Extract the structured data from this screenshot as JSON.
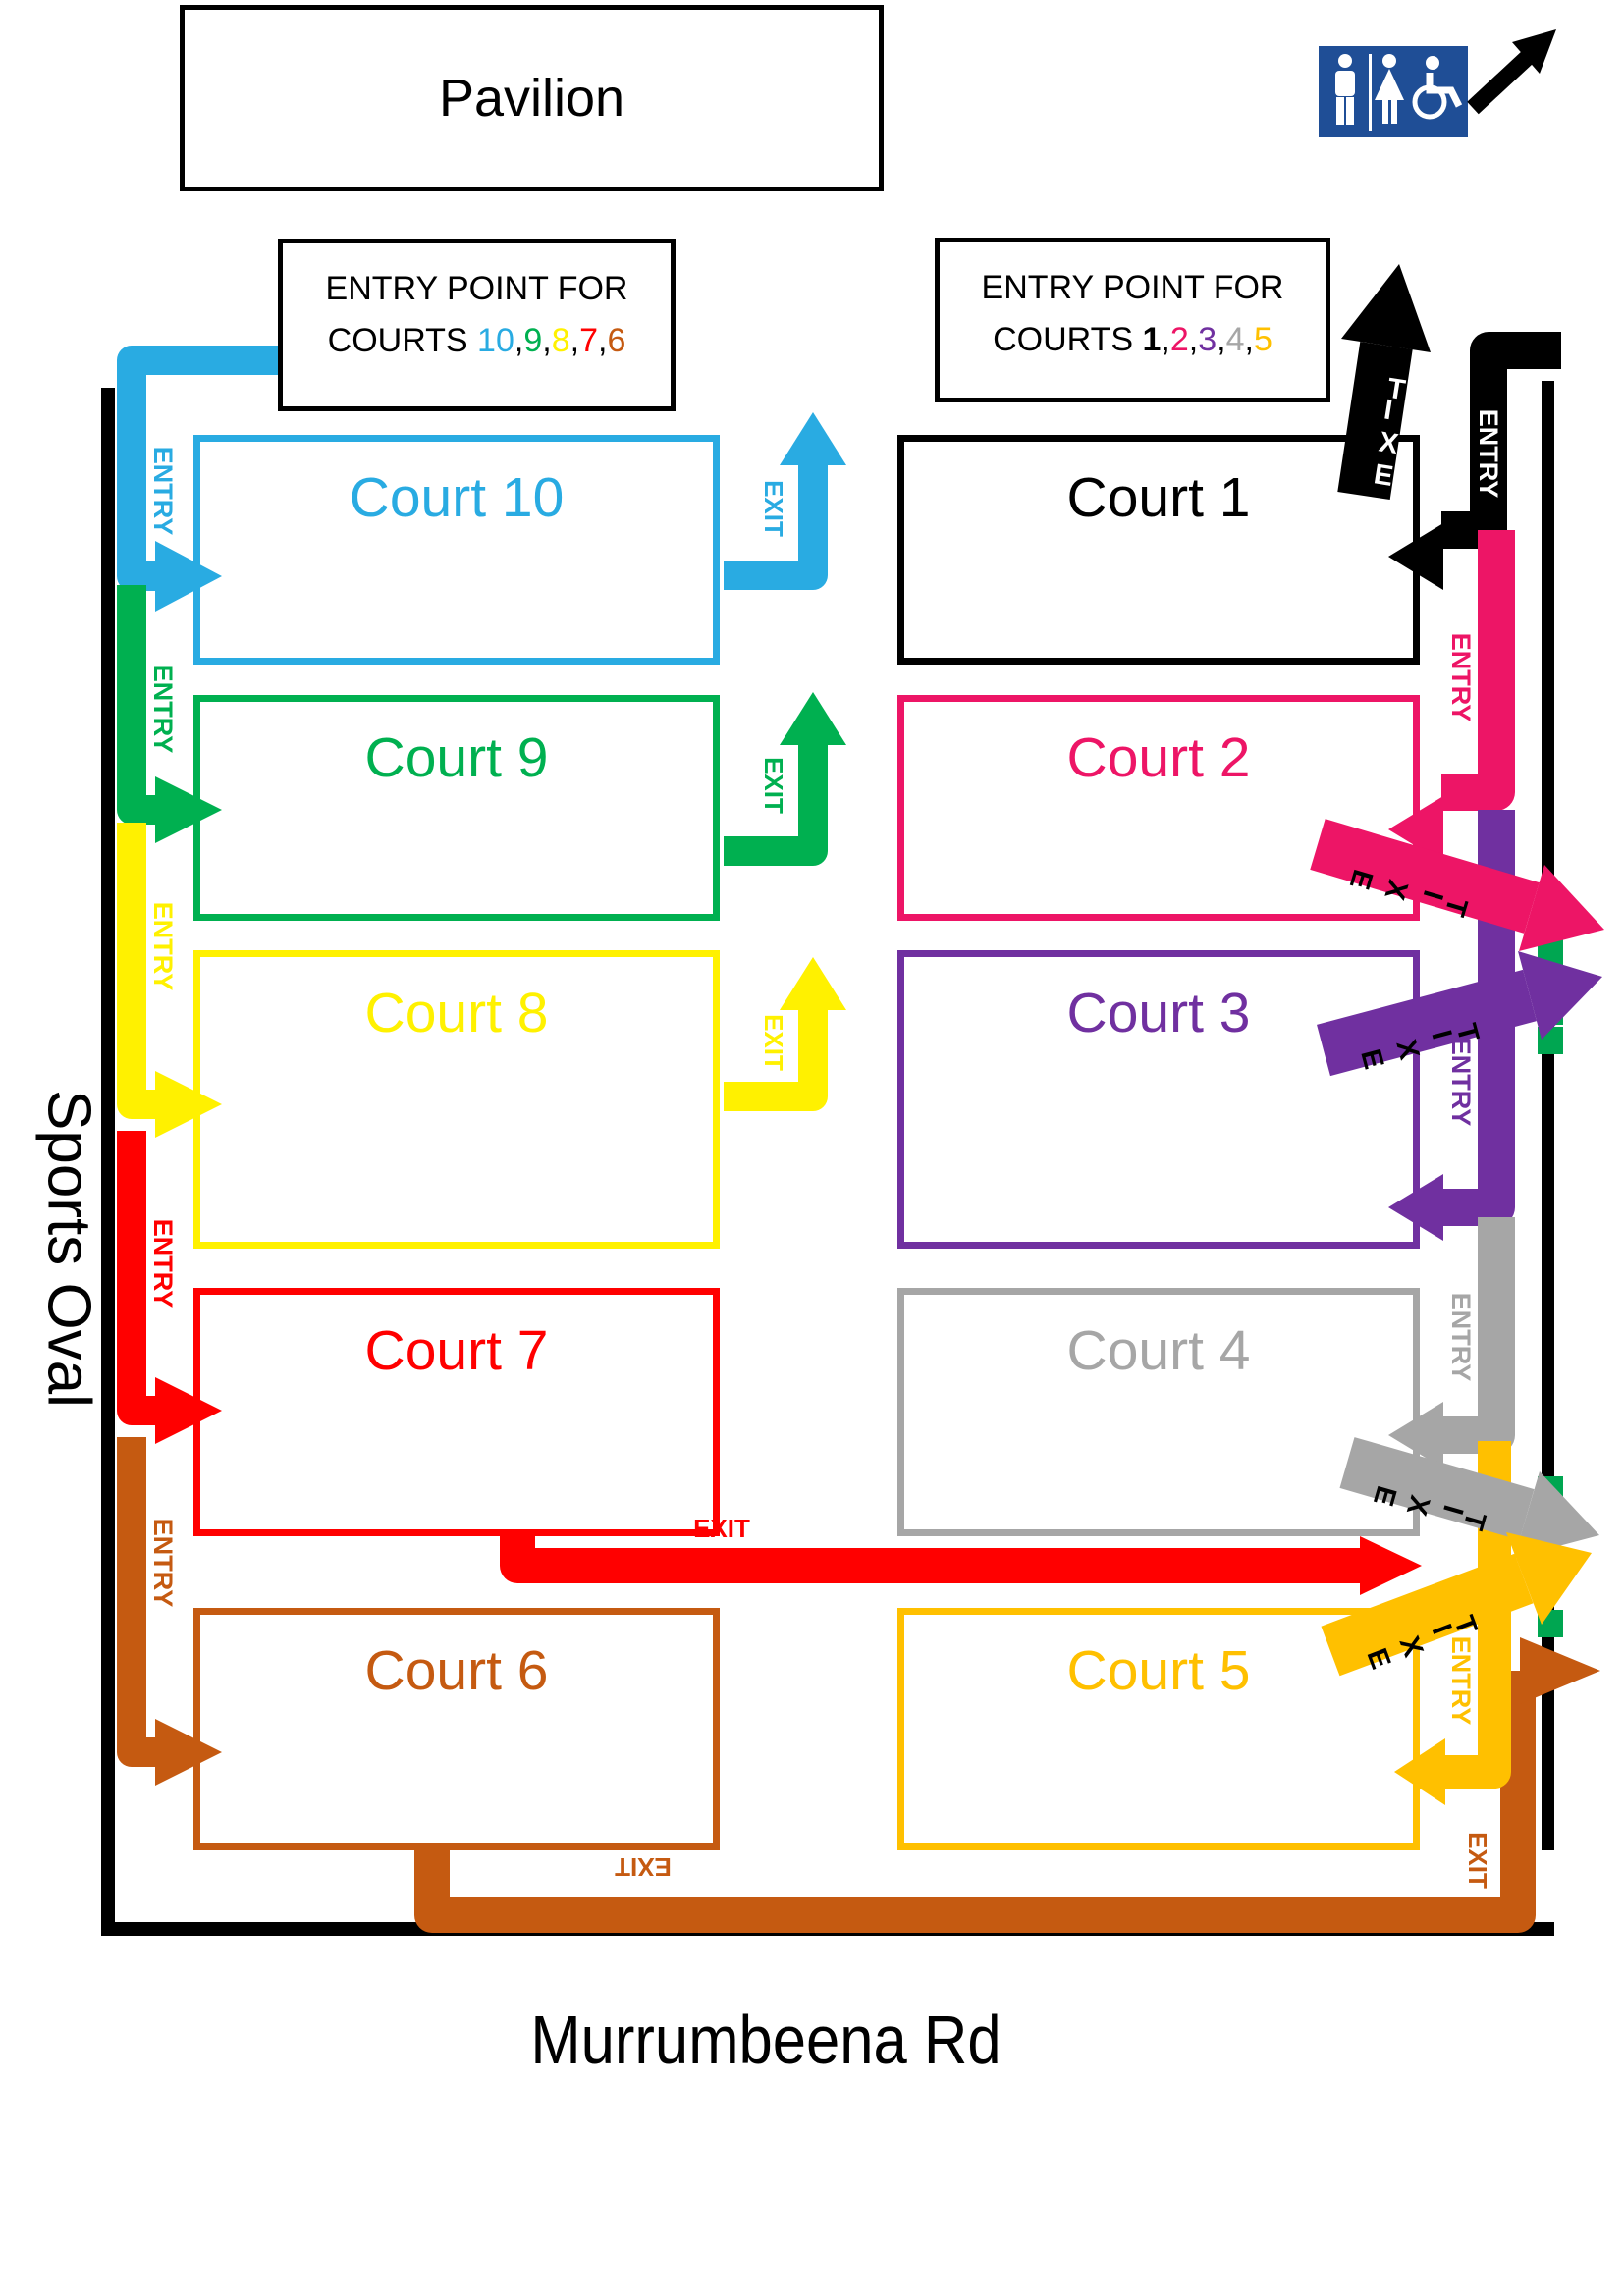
{
  "pavilion": {
    "label": "Pavilion"
  },
  "labels": {
    "entry": "ENTRY",
    "exit": "EXIT",
    "sports_oval": "Sports Oval",
    "road": "Murrumbeena Rd"
  },
  "entry_points": [
    {
      "line1": "ENTRY POINT FOR",
      "line2_prefix": "COURTS ",
      "courts": [
        {
          "value": "10",
          "color": "#29ABE2",
          "bold": false
        },
        {
          "value": "9",
          "color": "#00B050",
          "bold": false
        },
        {
          "value": "8",
          "color": "#FFF100",
          "bold": false
        },
        {
          "value": "7",
          "color": "#FF0000",
          "bold": false
        },
        {
          "value": "6",
          "color": "#C55A11",
          "bold": false
        }
      ]
    },
    {
      "line1": "ENTRY POINT FOR",
      "line2_prefix": "COURTS ",
      "courts": [
        {
          "value": "1",
          "color": "#000000",
          "bold": true
        },
        {
          "value": "2",
          "color": "#ED1566",
          "bold": false
        },
        {
          "value": "3",
          "color": "#7030A0",
          "bold": false
        },
        {
          "value": "4",
          "color": "#A6A6A6",
          "bold": false
        },
        {
          "value": "5",
          "color": "#FFC000",
          "bold": false
        }
      ]
    }
  ],
  "courts": [
    {
      "label": "Court 10",
      "color": "#29ABE2"
    },
    {
      "label": "Court 9",
      "color": "#00B050"
    },
    {
      "label": "Court 8",
      "color": "#FFF100"
    },
    {
      "label": "Court 7",
      "color": "#FF0000"
    },
    {
      "label": "Court 6",
      "color": "#C55A11"
    },
    {
      "label": "Court 1",
      "color": "#000000"
    },
    {
      "label": "Court 2",
      "color": "#ED1566"
    },
    {
      "label": "Court 3",
      "color": "#7030A0"
    },
    {
      "label": "Court 4",
      "color": "#A6A6A6"
    },
    {
      "label": "Court 5",
      "color": "#FFC000"
    }
  ],
  "structure_colors": {
    "fence": "#000000",
    "gate": "#00A651",
    "toilet_sign_bg": "#1F4E96"
  }
}
